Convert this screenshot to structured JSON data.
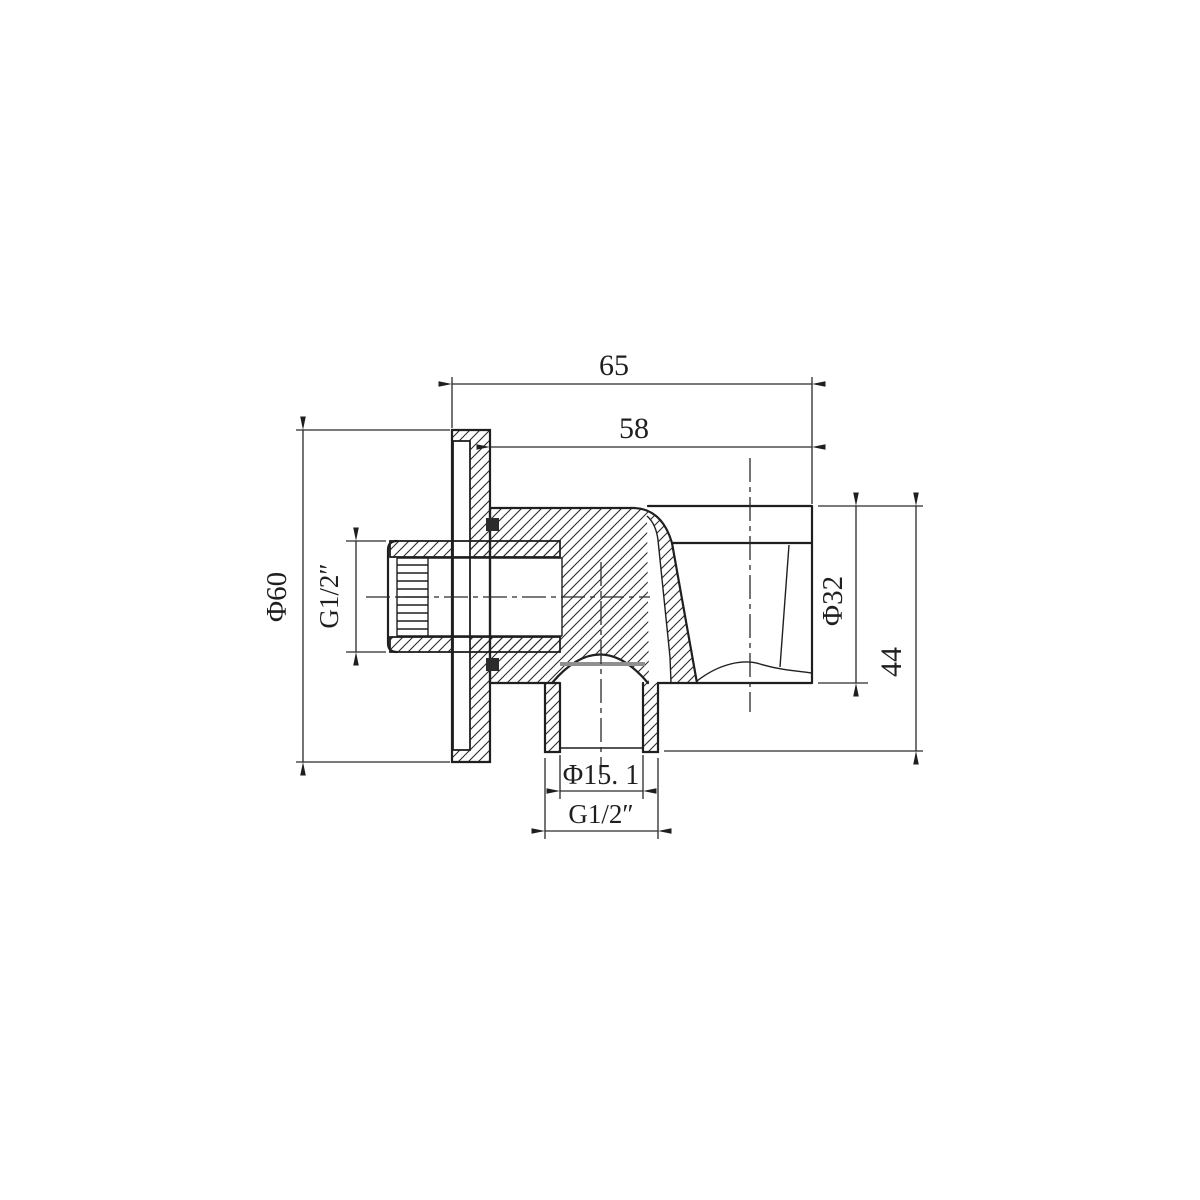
{
  "drawing": {
    "view": "sectional technical drawing",
    "colors": {
      "line": "#1f1f1f",
      "seal_line": "#8f8f8f",
      "background": "#ffffff"
    }
  },
  "dims": {
    "overall_width": "65",
    "body_width": "58",
    "flange_diameter": "Φ60",
    "inlet_thread": "G1/2″",
    "holder_diameter": "Φ32",
    "overall_height": "44",
    "outlet_bore": "Φ15. 1",
    "outlet_thread": "G1/2″"
  }
}
